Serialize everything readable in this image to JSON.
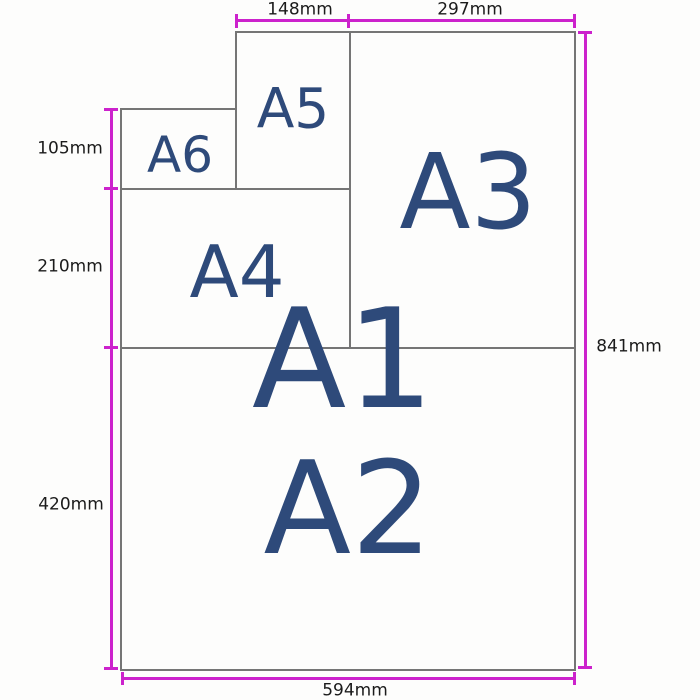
{
  "diagram": {
    "title": "A-series paper sizes",
    "paper_labels": {
      "a1": "A1",
      "a2": "A2",
      "a3": "A3",
      "a4": "A4",
      "a5": "A5",
      "a6": "A6"
    },
    "dimension_labels": {
      "top_a5_width": "148mm",
      "top_a3_width": "297mm",
      "left_a6_height": "105mm",
      "left_a4_height": "210mm",
      "left_a2_height": "420mm",
      "right_a1_height": "841mm",
      "bottom_a1_width": "594mm"
    },
    "colors": {
      "dimension_line": "#cc22cc",
      "paper_border": "#757575",
      "paper_label": "#2e4a7a",
      "dimension_text": "#1b1b1b",
      "background": "#ffffff"
    }
  }
}
